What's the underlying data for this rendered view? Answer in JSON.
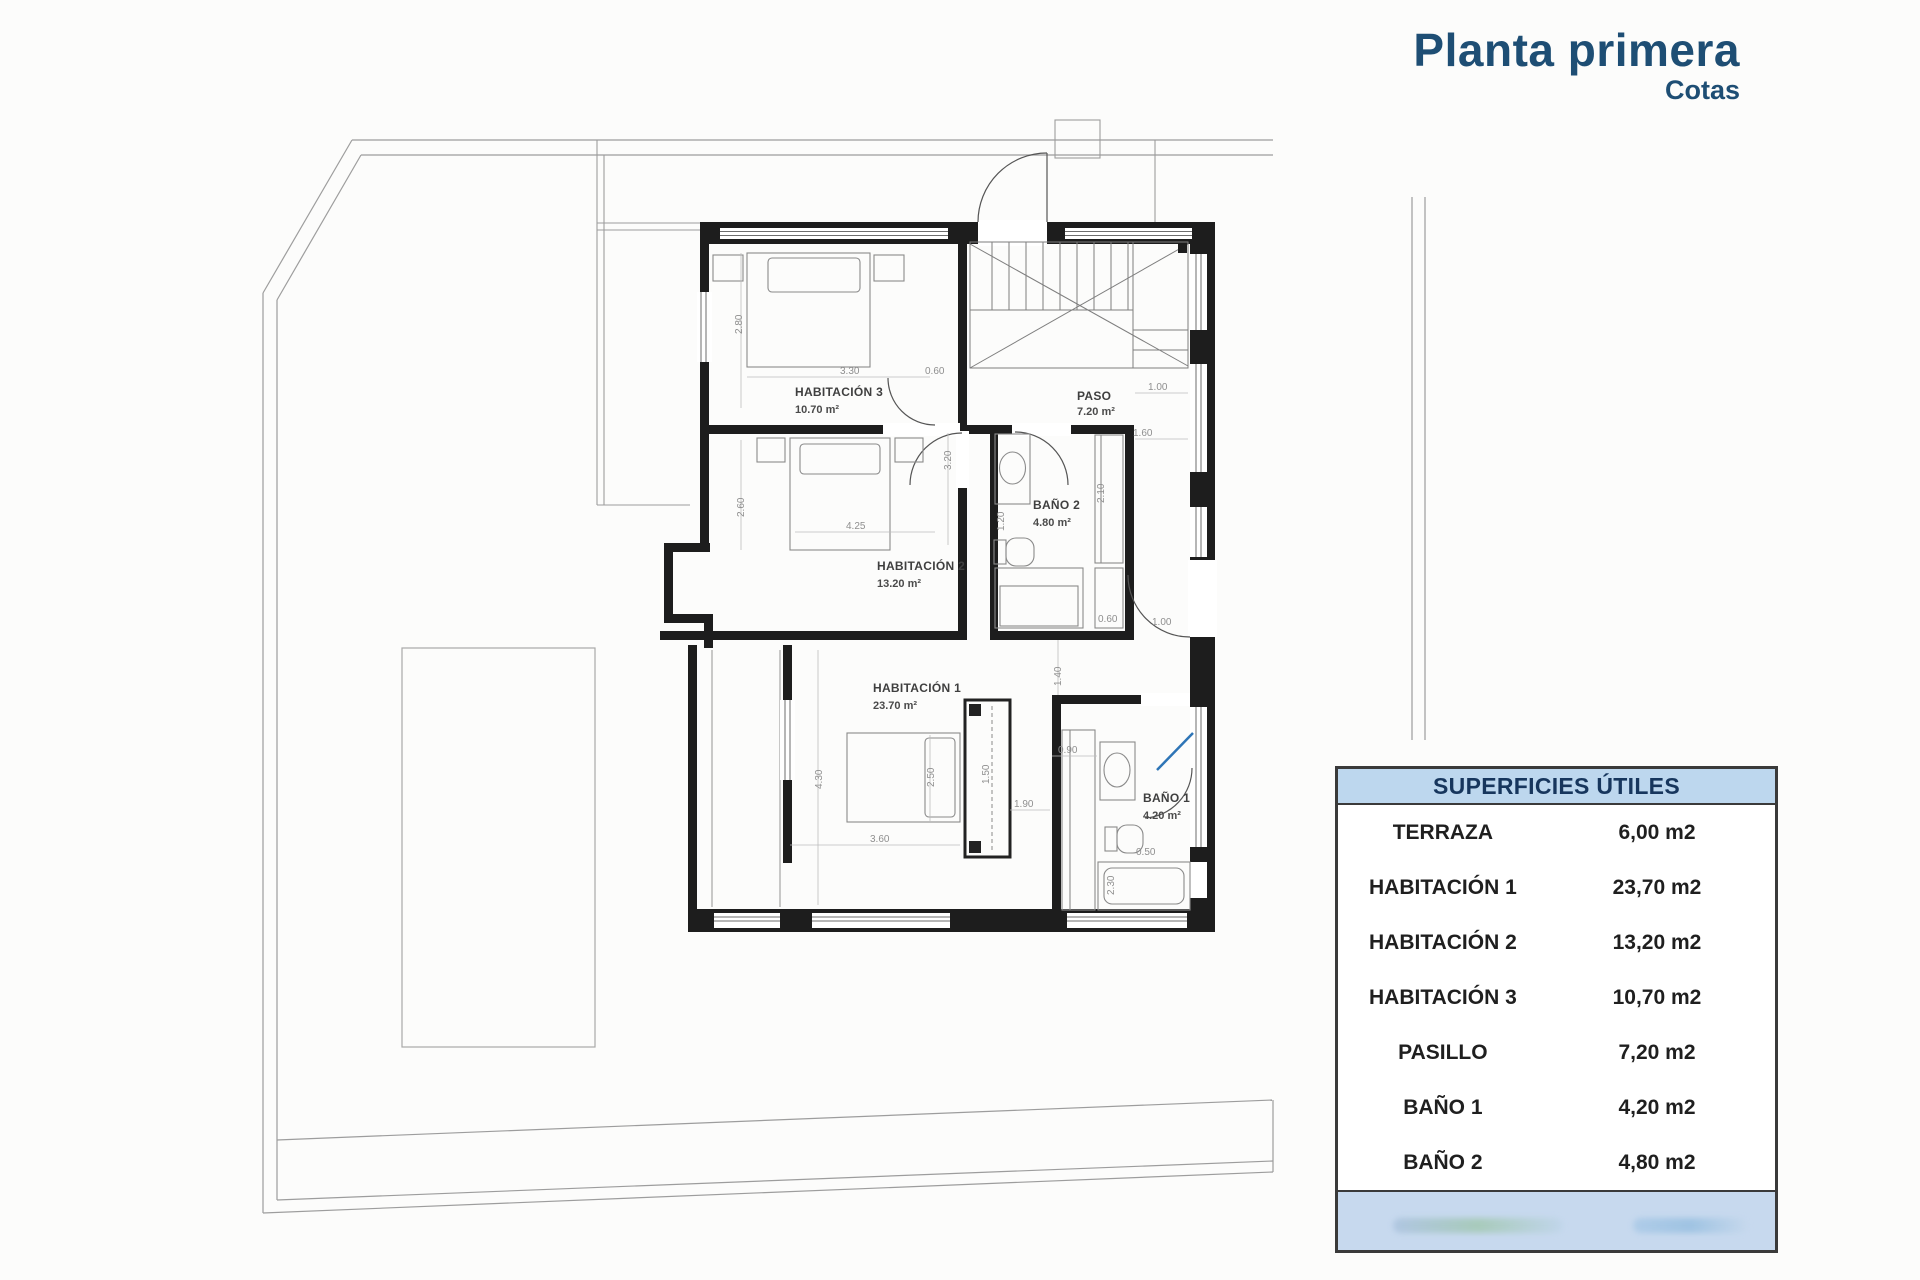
{
  "title": {
    "main": "Planta primera",
    "subtitle": "Cotas"
  },
  "table": {
    "header": "SUPERFICIES ÚTILES",
    "rows": [
      {
        "label": "TERRAZA",
        "value": "6,00 m2"
      },
      {
        "label": "HABITACIÓN 1",
        "value": "23,70 m2"
      },
      {
        "label": "HABITACIÓN 2",
        "value": "13,20 m2"
      },
      {
        "label": "HABITACIÓN 3",
        "value": "10,70 m2"
      },
      {
        "label": "PASILLO",
        "value": "7,20 m2"
      },
      {
        "label": "BAÑO 1",
        "value": "4,20 m2"
      },
      {
        "label": "BAÑO 2",
        "value": "4,80 m2"
      }
    ]
  },
  "plan": {
    "rooms": [
      {
        "name": "HABITACIÓN 3",
        "area": "10.70 m²"
      },
      {
        "name": "HABITACIÓN 2",
        "area": "13.20 m²"
      },
      {
        "name": "HABITACIÓN 1",
        "area": "23.70 m²"
      },
      {
        "name": "PASO",
        "area": "7.20 m²"
      },
      {
        "name": "BAÑO 2",
        "area": "4.80 m²"
      },
      {
        "name": "BAÑO 1",
        "area": "4.20 m²"
      }
    ],
    "dims": [
      "2.80",
      "3.30",
      "0.60",
      "2.60",
      "4.25",
      "3.20",
      "1.20",
      "2.10",
      "1.00",
      "1.60",
      "0.60",
      "1.00",
      "1.40",
      "4.30",
      "3.60",
      "2.50",
      "1.50",
      "1.90",
      "0.90",
      "0.50",
      "2.30"
    ]
  },
  "colors": {
    "title_blue": "#1e4e74",
    "table_header_bg": "#bdd7ee",
    "table_footer_bg": "#c7d9ee",
    "wall": "#1d1d1d",
    "door_marker_blue": "#2e75b6"
  }
}
